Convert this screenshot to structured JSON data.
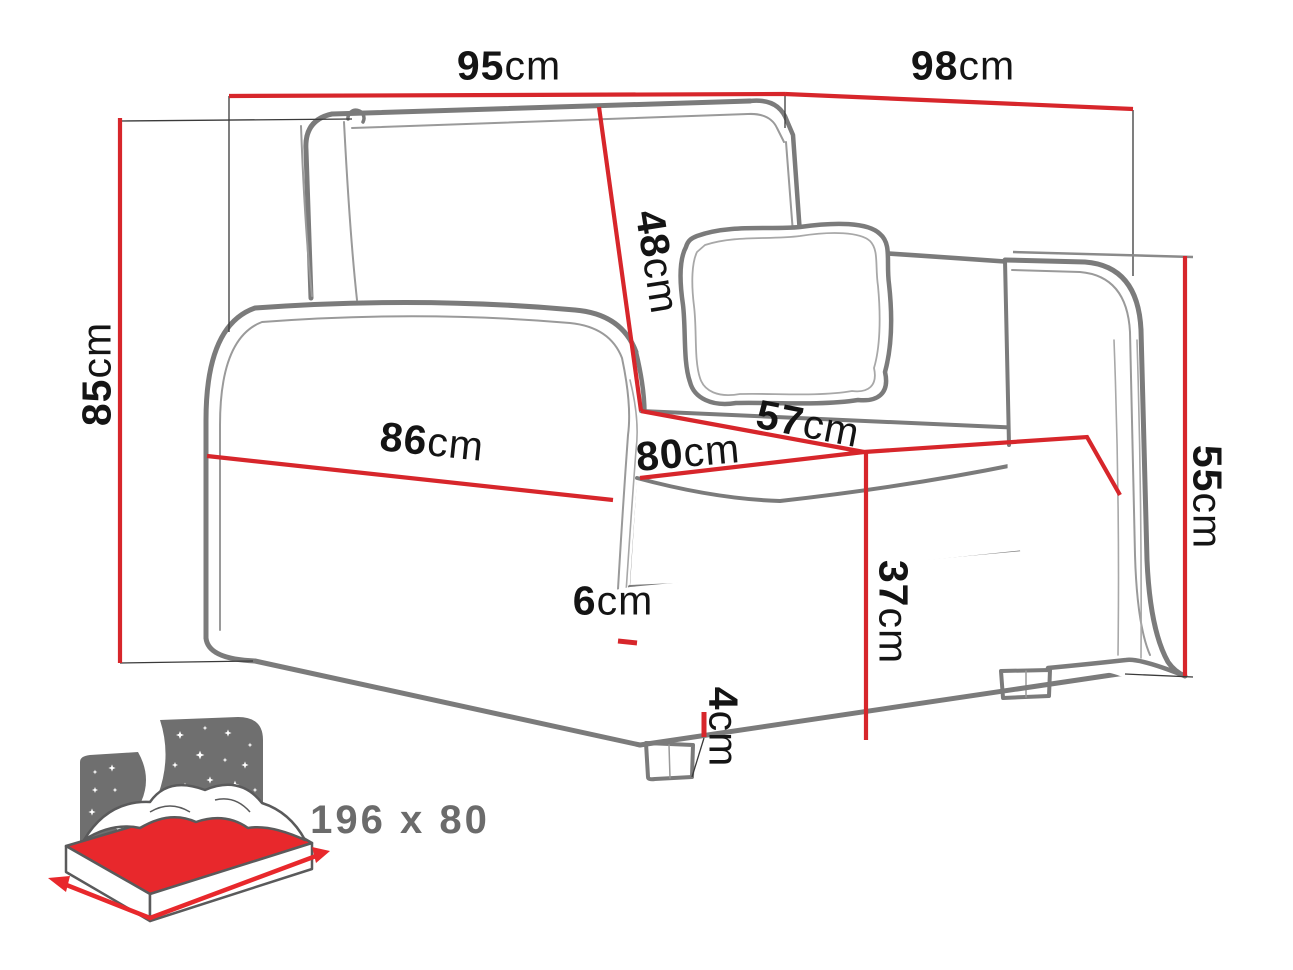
{
  "colors": {
    "dimension_line": "#d7262b",
    "outline_gray": "#7b7b7b",
    "icon_gray": "#6f6f6f",
    "label_text": "#141414",
    "sleeping_label_text": "#6b6b6b",
    "mattress_red": "#e8282c",
    "background": "#ffffff"
  },
  "dimensions": {
    "front_width": {
      "value": "95",
      "unit": "cm"
    },
    "side_depth": {
      "value": "98",
      "unit": "cm"
    },
    "total_height": {
      "value": "85",
      "unit": "cm"
    },
    "backrest_height": {
      "value": "48",
      "unit": "cm"
    },
    "front_bottom_width": {
      "value": "86",
      "unit": "cm"
    },
    "seat_depth": {
      "value": "80",
      "unit": "cm"
    },
    "seat_width": {
      "value": "57",
      "unit": "cm"
    },
    "armrest_height": {
      "value": "55",
      "unit": "cm"
    },
    "seat_height": {
      "value": "37",
      "unit": "cm"
    },
    "side_gap": {
      "value": "6",
      "unit": "cm"
    },
    "leg_height": {
      "value": "4",
      "unit": "cm"
    }
  },
  "sleeping_area": {
    "label": "196 x 80"
  },
  "icons": {
    "sleeping_function": "bed-with-starry-night-icon"
  }
}
